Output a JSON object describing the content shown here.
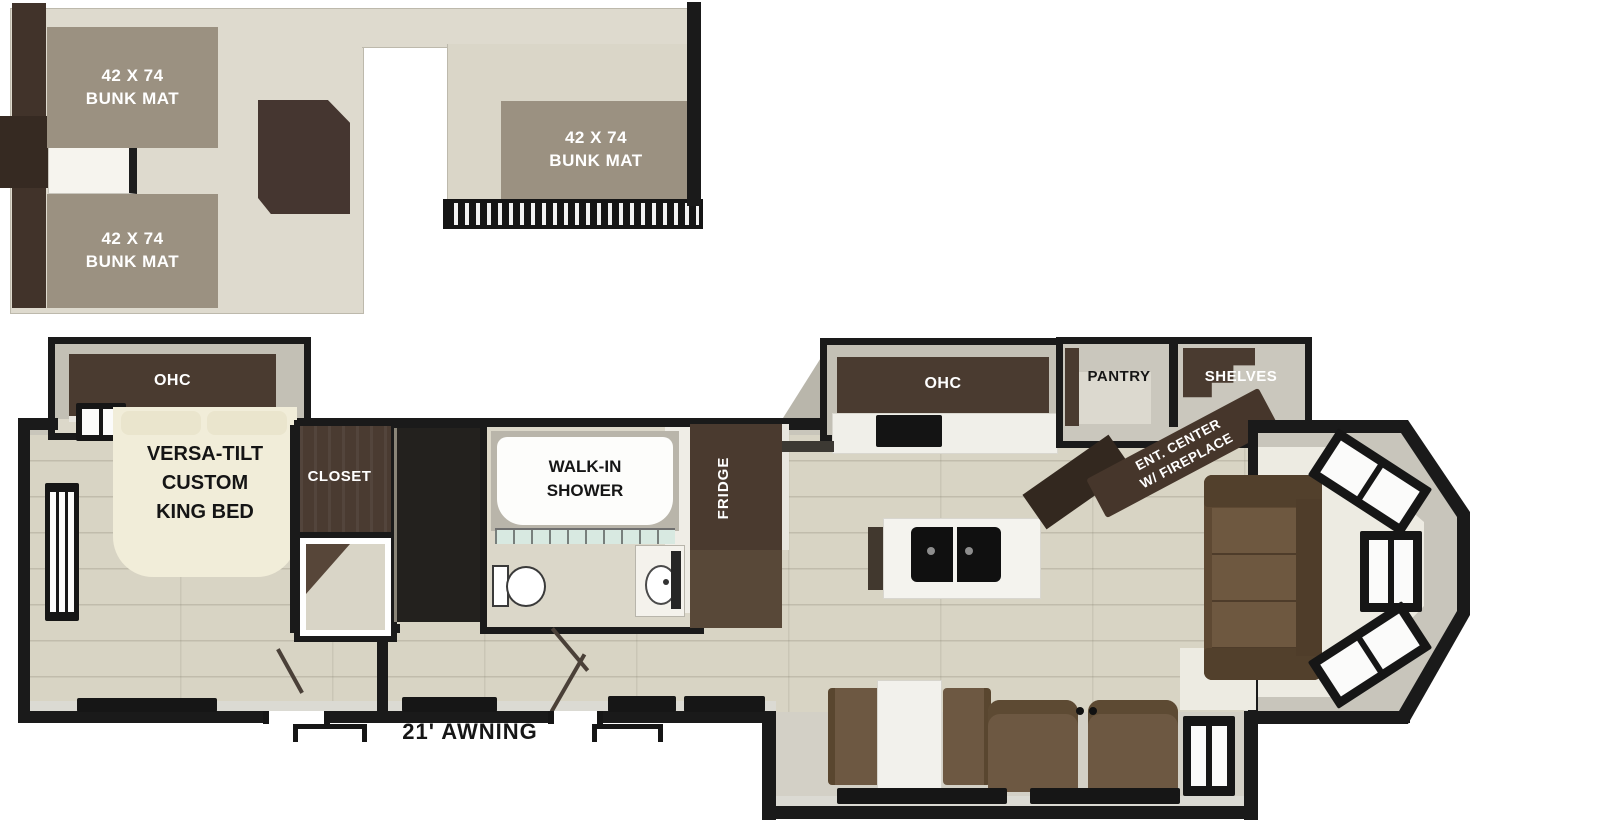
{
  "title": "RV destination trailer floor plan with loft",
  "loft": {
    "bunk_mat_top": {
      "l1": "42 X 74",
      "l2": "BUNK MAT"
    },
    "bunk_mat_bottom": {
      "l1": "42 X 74",
      "l2": "BUNK MAT"
    },
    "bunk_mat_rear": {
      "l1": "42 X 74",
      "l2": "BUNK MAT"
    }
  },
  "bedroom": {
    "ohc": "OHC",
    "closet": "CLOSET",
    "bed": {
      "l1": "VERSA-TILT",
      "l2": "CUSTOM",
      "l3": "KING BED"
    }
  },
  "bathroom": {
    "shower": {
      "l1": "WALK-IN",
      "l2": "SHOWER"
    }
  },
  "kitchen": {
    "fridge": "FRIDGE",
    "ohc": "OHC",
    "pantry": "PANTRY",
    "shelves": "SHELVES"
  },
  "living_area": {
    "ent_center": {
      "l1": "ENT. CENTER",
      "l2": "W/ FIREPLACE"
    }
  },
  "exterior": {
    "awning": "21' AWNING"
  },
  "colors": {
    "wall": "#1a1a1a",
    "loft_floor": "#dedace",
    "bunk_mat": "#9b9181",
    "dark_cabinet": "#47382e",
    "wood_floor": "#d8d4c4",
    "slide_wall_gray": "#c6c3b8",
    "sofa_brown": "#6a543c",
    "counter_white": "#f2f1ec",
    "shower_glass": "#d8e9e1"
  }
}
